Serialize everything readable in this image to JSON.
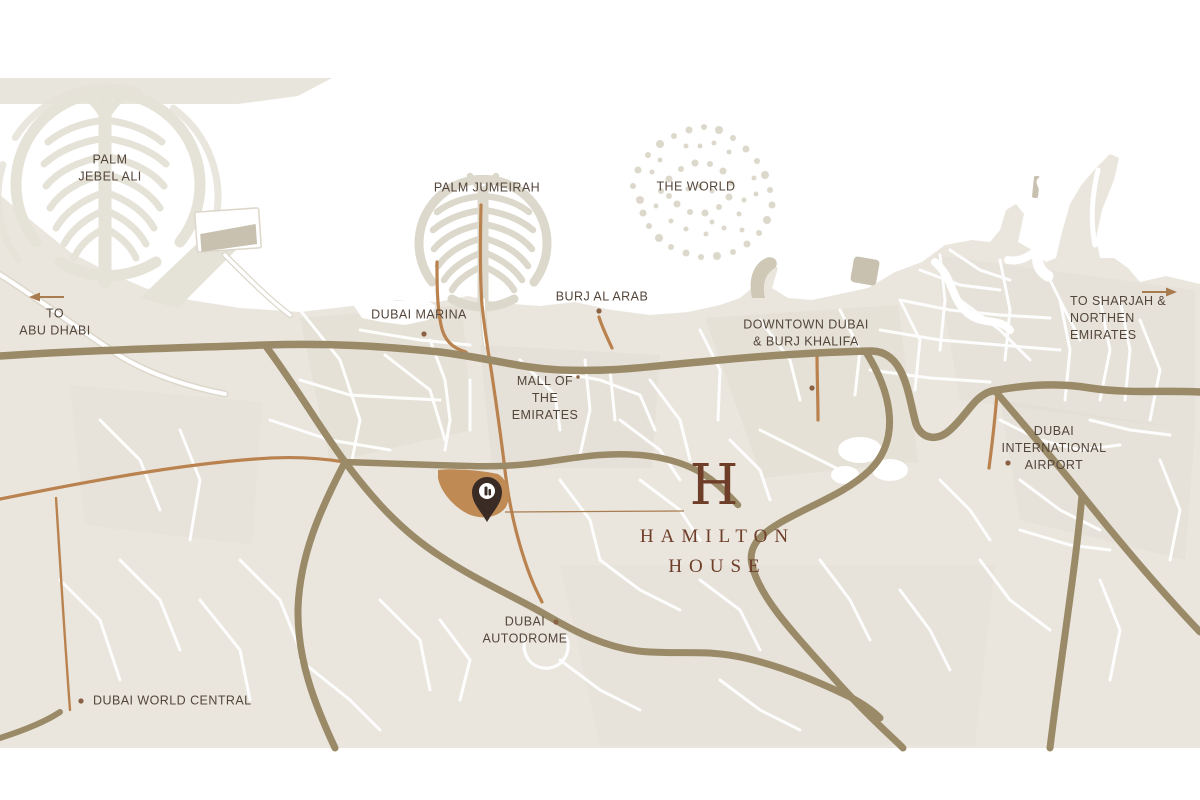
{
  "map": {
    "colors": {
      "sea": "#ffffff",
      "land": "#eae6de",
      "land-shade": "#e0dbd0",
      "island": "#dcd8cb",
      "island-light": "#e5e2d8",
      "port": "#c9c1b0",
      "road-major": "#9a8a67",
      "road-accent": "#b9824f",
      "road-casing": "#dcd7ca",
      "label": "#54453a",
      "brand": "#6e3e28",
      "site": "#c08a55",
      "pin": "#3a2c24",
      "marker": "#8a6143",
      "arrow": "#a87c4f"
    },
    "labels": {
      "palm_jebel_ali": "PALM\nJEBEL ALI",
      "to_abu_dhabi": "TO\nABU DHABI",
      "palm_jumeirah": "PALM JUMEIRAH",
      "dubai_marina": "DUBAI MARINA",
      "burj_al_arab": "BURJ AL ARAB",
      "the_world": "THE WORLD",
      "mall_of_the_emirates": "MALL OF\nTHE\nEMIRATES",
      "downtown_dubai": "DOWNTOWN DUBAI\n& BURJ KHALIFA",
      "to_sharjah": "TO SHARJAH &\nNORTHEN EMIRATES",
      "dubai_international_airport": "DUBAI\nINTERNATIONAL\nAIRPORT",
      "dubai_autodrome": "DUBAI\nAUTODROME",
      "dubai_world_central": "DUBAI WORLD CENTRAL"
    },
    "brand": {
      "monogram": "H",
      "line1": "HAMILTON",
      "line2": "HOUSE"
    }
  }
}
